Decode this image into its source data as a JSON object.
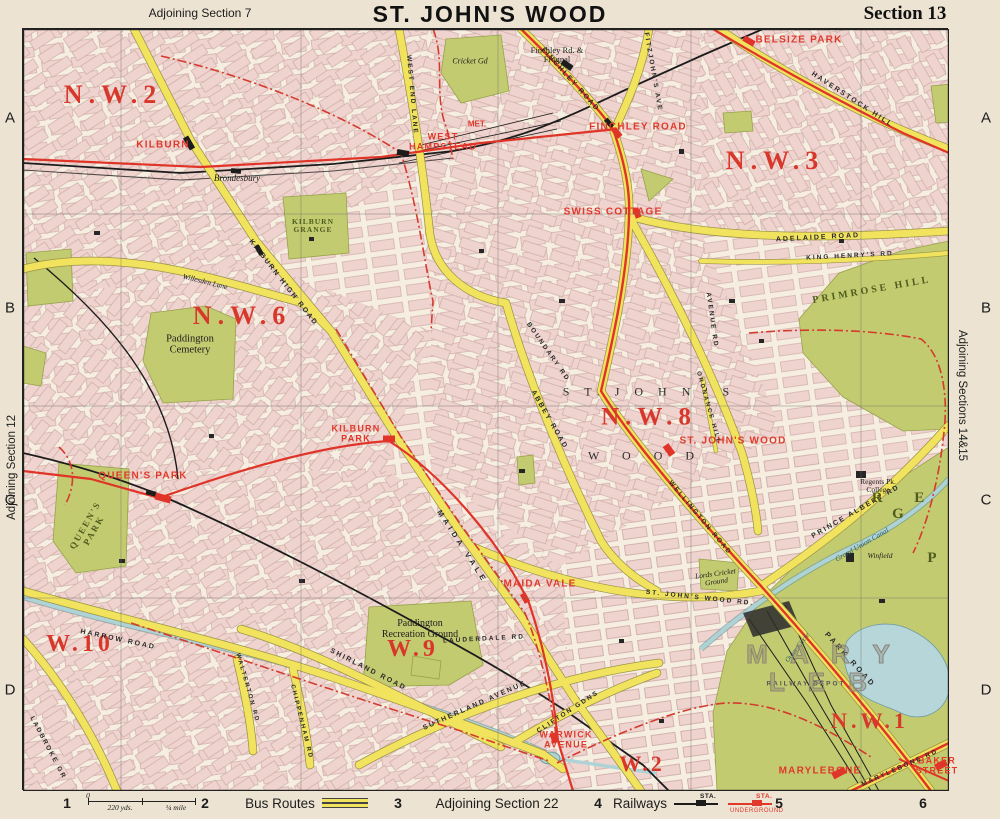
{
  "header": {
    "adjoining_top": "Adjoining Section 7",
    "title": "ST. JOHN'S WOOD",
    "section": "Section 13"
  },
  "margins": {
    "left": "Adjoining Section 12",
    "right": "Adjoining Sections 14&15"
  },
  "grid": {
    "rows": [
      "A",
      "B",
      "C",
      "D"
    ],
    "row_y": [
      118,
      308,
      500,
      690
    ],
    "cols": [
      "1",
      "2",
      "3",
      "4",
      "5",
      "6"
    ],
    "col_x": [
      67,
      205,
      398,
      598,
      779,
      923
    ]
  },
  "legend": {
    "scale": {
      "zero": "0",
      "mid": "220 yds.",
      "end": "¼ mile"
    },
    "bus_label": "Bus Routes",
    "adjoining_bottom": "Adjoining Section 22",
    "railways_label": "Railways",
    "sta": "STA.",
    "underground": "UNDERGROUND"
  },
  "colors": {
    "paper": "#ece3d2",
    "map_bg": "#f6efe1",
    "block_pink": "#efd2ce",
    "park_green": "#c2cb70",
    "road_yellow": "#f2e35e",
    "route_red": "#e03428",
    "rail_black": "#1c1c1c",
    "water_blue": "#aed3d6",
    "label_red": "#d8382b"
  },
  "map": {
    "labels": [
      {
        "id": "nw2",
        "t": "N.W.2",
        "x": 113,
        "y": 95,
        "s": 26,
        "sp": 6,
        "k": "district"
      },
      {
        "id": "nw3",
        "t": "N.W.3",
        "x": 775,
        "y": 161,
        "s": 26,
        "sp": 6,
        "k": "district"
      },
      {
        "id": "nw6",
        "t": "N.W.6",
        "x": 242,
        "y": 316,
        "s": 26,
        "sp": 6,
        "k": "district"
      },
      {
        "id": "nw8",
        "t": "N.W.8",
        "x": 649,
        "y": 417,
        "s": 25,
        "sp": 6,
        "k": "district"
      },
      {
        "id": "w10",
        "t": "W.10",
        "x": 80,
        "y": 645,
        "s": 24,
        "sp": 4,
        "k": "district"
      },
      {
        "id": "w9",
        "t": "W.9",
        "x": 413,
        "y": 650,
        "s": 24,
        "sp": 4,
        "k": "district"
      },
      {
        "id": "w2",
        "t": "W.2",
        "x": 642,
        "y": 764,
        "s": 22,
        "sp": 3,
        "k": "district"
      },
      {
        "id": "nw1",
        "t": "N.W.1",
        "x": 870,
        "y": 721,
        "s": 22,
        "sp": 4,
        "k": "district"
      },
      {
        "id": "sta-kilburn",
        "t": "KILBURN",
        "x": 163,
        "y": 146,
        "s": 10,
        "k": "sta"
      },
      {
        "id": "sta-west-hampstead",
        "t": "WEST\nHAMPSTEAD",
        "x": 443,
        "y": 142,
        "s": 9,
        "k": "sta"
      },
      {
        "id": "sta-finchley-road",
        "t": "FINCHLEY ROAD",
        "x": 638,
        "y": 128,
        "s": 10,
        "k": "sta"
      },
      {
        "id": "sta-swiss-cottage",
        "t": "SWISS COTTAGE",
        "x": 613,
        "y": 213,
        "s": 10,
        "k": "sta"
      },
      {
        "id": "sta-belsize-park",
        "t": "BELSIZE PARK",
        "x": 799,
        "y": 41,
        "s": 10,
        "k": "sta"
      },
      {
        "id": "sta-queens-park",
        "t": "QUEEN'S PARK",
        "x": 143,
        "y": 477,
        "s": 10,
        "k": "sta"
      },
      {
        "id": "sta-kilburn-park",
        "t": "KILBURN\nPARK",
        "x": 356,
        "y": 434,
        "s": 9,
        "k": "sta"
      },
      {
        "id": "sta-st-johns-wood",
        "t": "ST. JOHN'S WOOD",
        "x": 733,
        "y": 442,
        "s": 10,
        "k": "sta"
      },
      {
        "id": "sta-maida-vale",
        "t": "MAIDA VALE",
        "x": 540,
        "y": 585,
        "s": 10,
        "k": "sta"
      },
      {
        "id": "sta-warwick-avenue",
        "t": "WARWICK\nAVENUE",
        "x": 566,
        "y": 740,
        "s": 9,
        "k": "sta"
      },
      {
        "id": "sta-marylebone",
        "t": "MARYLEBONE",
        "x": 820,
        "y": 772,
        "s": 10,
        "k": "sta"
      },
      {
        "id": "sta-baker-street",
        "t": "BAKER\nSTREET",
        "x": 937,
        "y": 766,
        "s": 9,
        "k": "sta"
      },
      {
        "id": "met",
        "t": "MET.",
        "x": 477,
        "y": 125,
        "s": 8,
        "k": "met"
      },
      {
        "id": "brondesbury",
        "t": "Brondesbury",
        "x": 237,
        "y": 179,
        "s": 9,
        "k": "place"
      },
      {
        "id": "frognal",
        "t": "Finchley Rd. &\nFrognal",
        "x": 557,
        "y": 55,
        "s": 8.5,
        "k": "placer"
      },
      {
        "id": "cricket-gd",
        "t": "Cricket Gd",
        "x": 470,
        "y": 62,
        "s": 8,
        "k": "place"
      },
      {
        "id": "kilburn-grange",
        "t": "KILBURN\nGRANGE",
        "x": 313,
        "y": 226,
        "s": 7.5,
        "sp": 1,
        "k": "park"
      },
      {
        "id": "paddington-cemetery",
        "t": "Paddington\nCemetery",
        "x": 190,
        "y": 345,
        "s": 10.5,
        "k": "placer"
      },
      {
        "id": "queens-park-name",
        "t": "QUEEN'S\nPARK",
        "x": 90,
        "y": 528,
        "s": 9,
        "sp": 2,
        "r": -60,
        "k": "park"
      },
      {
        "id": "paddington-rec",
        "t": "Paddington\nRecreation Ground",
        "x": 420,
        "y": 630,
        "s": 10,
        "k": "placer"
      },
      {
        "id": "primrose-hill",
        "t": "PRIMROSE HILL",
        "x": 872,
        "y": 291,
        "s": 10,
        "sp": 3,
        "r": -10,
        "k": "park"
      },
      {
        "id": "regents-college",
        "t": "Regents Pk.\nCollege",
        "x": 878,
        "y": 486,
        "s": 7.5,
        "k": "placer"
      },
      {
        "id": "winfield",
        "t": "Winfield",
        "x": 880,
        "y": 556,
        "s": 7.5,
        "k": "place"
      },
      {
        "id": "lords",
        "t": "Lords Cricket\nGround",
        "x": 716,
        "y": 578,
        "s": 7.5,
        "r": -8,
        "k": "place"
      },
      {
        "id": "railway-depot",
        "t": "RAILWAY DEPOT",
        "x": 806,
        "y": 684,
        "s": 6.5,
        "sp": 2,
        "k": "road",
        "c": "#555"
      },
      {
        "id": "grand-union-canal",
        "t": "Grand Union Canal",
        "x": 862,
        "y": 545,
        "s": 7.5,
        "r": -30,
        "k": "water"
      },
      {
        "id": "outer-circle",
        "t": "Outer Circle",
        "x": 798,
        "y": 648,
        "s": 7,
        "r": -52,
        "k": "water"
      },
      {
        "id": "rd-west-end-lane",
        "t": "WEST END LANE",
        "x": 412,
        "y": 95,
        "s": 6.5,
        "r": 85,
        "k": "road"
      },
      {
        "id": "rd-fitzjohns",
        "t": "FITZJOHN'S AVE",
        "x": 653,
        "y": 72,
        "s": 6.5,
        "r": 80,
        "k": "road"
      },
      {
        "id": "rd-finchley",
        "t": "FINCHLEY ROAD",
        "x": 570,
        "y": 80,
        "s": 7,
        "r": 48,
        "k": "road"
      },
      {
        "id": "rd-haverstock",
        "t": "HAVERSTOCK HILL",
        "x": 852,
        "y": 100,
        "s": 7,
        "r": 33,
        "k": "road"
      },
      {
        "id": "rd-adelaide",
        "t": "ADELAIDE ROAD",
        "x": 818,
        "y": 238,
        "s": 7,
        "r": -3,
        "k": "road"
      },
      {
        "id": "rd-king-henrys",
        "t": "KING HENRY'S RD",
        "x": 850,
        "y": 256,
        "s": 6.5,
        "r": -3,
        "k": "road"
      },
      {
        "id": "rd-kilburn-high",
        "t": "KILBURN HIGH ROAD",
        "x": 283,
        "y": 283,
        "s": 7,
        "r": 52,
        "k": "road"
      },
      {
        "id": "rd-willesden-lane",
        "t": "Willesden Lane",
        "x": 205,
        "y": 282,
        "s": 7.5,
        "r": 14,
        "k": "place"
      },
      {
        "id": "rd-abbey",
        "t": "ABBEY ROAD",
        "x": 549,
        "y": 420,
        "s": 7,
        "r": 60,
        "k": "road"
      },
      {
        "id": "rd-boundary",
        "t": "BOUNDARY RD",
        "x": 548,
        "y": 352,
        "s": 6.5,
        "r": 55,
        "k": "road"
      },
      {
        "id": "rd-maida-vale",
        "t": "MAIDA VALE",
        "x": 462,
        "y": 547,
        "s": 7.5,
        "sp": 4,
        "r": 57,
        "k": "road"
      },
      {
        "id": "rd-shirland",
        "t": "SHIRLAND ROAD",
        "x": 368,
        "y": 670,
        "s": 7,
        "r": 27,
        "k": "road"
      },
      {
        "id": "rd-sutherland",
        "t": "SUTHERLAND AVENUE",
        "x": 475,
        "y": 706,
        "s": 7,
        "r": -24,
        "k": "road"
      },
      {
        "id": "rd-lauderdale",
        "t": "LAUDERDALE RD",
        "x": 484,
        "y": 639,
        "s": 6.5,
        "r": -3,
        "k": "road"
      },
      {
        "id": "rd-clifton",
        "t": "CLIFTON GDNS",
        "x": 568,
        "y": 712,
        "s": 6.5,
        "r": -33,
        "k": "road"
      },
      {
        "id": "rd-harrow",
        "t": "HARROW ROAD",
        "x": 118,
        "y": 640,
        "s": 7,
        "r": 12,
        "k": "road"
      },
      {
        "id": "rd-ladbroke",
        "t": "LADBROKE GR",
        "x": 48,
        "y": 748,
        "s": 6.5,
        "r": 62,
        "k": "road"
      },
      {
        "id": "rd-walterton",
        "t": "WALTERTON RD",
        "x": 247,
        "y": 688,
        "s": 6,
        "r": 74,
        "k": "road"
      },
      {
        "id": "rd-chippenham",
        "t": "CHIPPENHAM RD",
        "x": 301,
        "y": 722,
        "s": 6,
        "r": 76,
        "k": "road"
      },
      {
        "id": "rd-wellington",
        "t": "WELLINGTON ROAD",
        "x": 700,
        "y": 518,
        "s": 6.5,
        "r": 50,
        "k": "road"
      },
      {
        "id": "rd-ordnance",
        "t": "ORDNANCE HILL",
        "x": 708,
        "y": 408,
        "s": 6,
        "r": 74,
        "k": "road"
      },
      {
        "id": "rd-avenue",
        "t": "AVENUE RD",
        "x": 712,
        "y": 320,
        "s": 6.5,
        "r": 82,
        "k": "road"
      },
      {
        "id": "rd-st-johns-wood-rd",
        "t": "ST. JOHN'S WOOD RD.",
        "x": 700,
        "y": 598,
        "s": 6.5,
        "r": 6,
        "k": "road"
      },
      {
        "id": "rd-park-road",
        "t": "PARK ROAD",
        "x": 850,
        "y": 660,
        "s": 7.5,
        "sp": 3,
        "r": 48,
        "k": "road"
      },
      {
        "id": "rd-prince-albert",
        "t": "PRINCE ALBERT RD",
        "x": 856,
        "y": 512,
        "s": 7,
        "r": -30,
        "k": "road"
      },
      {
        "id": "rd-marylebone-rd",
        "t": "MARYLEBONE RD",
        "x": 900,
        "y": 768,
        "s": 6.5,
        "r": -24,
        "k": "road"
      },
      {
        "id": "spread-st-johns",
        "t": "S T.  J O H N ' S",
        "x": 649,
        "y": 392,
        "s": 12,
        "sp": 6,
        "k": "spread"
      },
      {
        "id": "spread-wood",
        "t": "W O O D",
        "x": 646,
        "y": 456,
        "s": 12,
        "sp": 10,
        "k": "spread"
      },
      {
        "id": "maryleb-outline",
        "t": "M A R Y L E B",
        "x": 822,
        "y": 668,
        "s": 26,
        "sp": 8,
        "k": "outline"
      },
      {
        "id": "reg-letters",
        "t": "R E G",
        "x": 905,
        "y": 506,
        "s": 15,
        "sp": 14,
        "k": "park"
      },
      {
        "id": "reg-p",
        "t": "P",
        "x": 932,
        "y": 558,
        "s": 15,
        "k": "park"
      }
    ]
  }
}
